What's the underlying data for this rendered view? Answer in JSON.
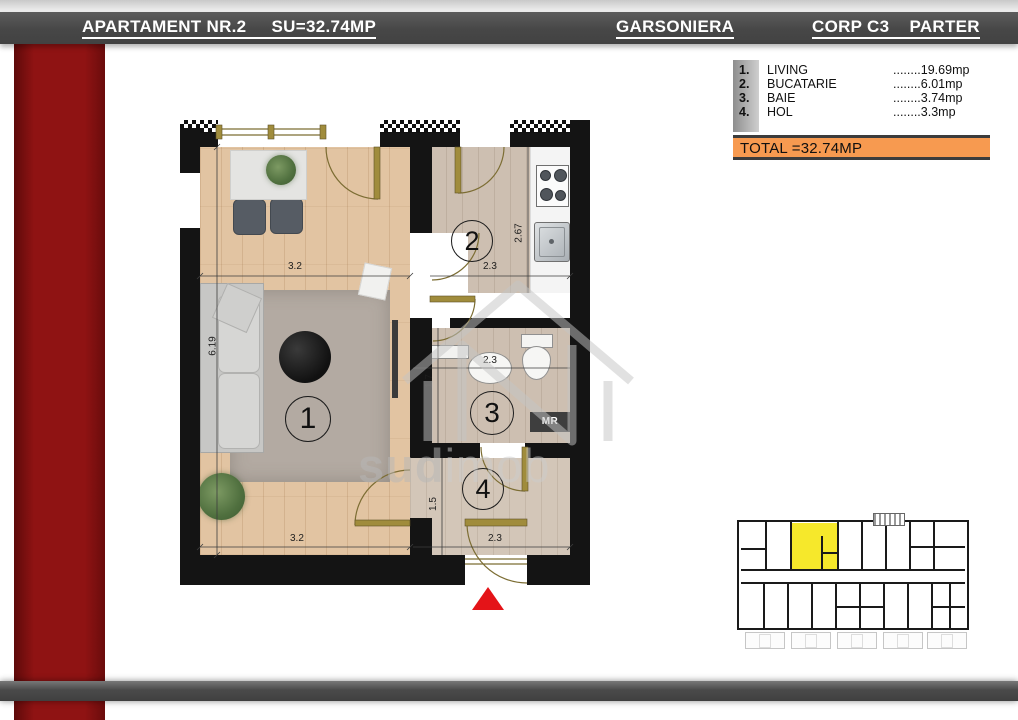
{
  "header": {
    "left": "APARTAMENT NR.2     SU=32.74MP",
    "center": "GARSONIERA",
    "right": "CORP C3    PARTER"
  },
  "legend": {
    "items": [
      {
        "num": "1.",
        "name": "LIVING",
        "value": "........19.69mp"
      },
      {
        "num": "2.",
        "name": "BUCATARIE",
        "value": "........6.01mp"
      },
      {
        "num": "3.",
        "name": "BAIE",
        "value": "........3.74mp"
      },
      {
        "num": "4.",
        "name": "HOL",
        "value": "........3.3mp"
      }
    ],
    "total": "TOTAL =32.74MP"
  },
  "plan": {
    "rooms": {
      "living": "1",
      "kitchen": "2",
      "bath": "3",
      "hall": "4"
    },
    "dims": {
      "living_top": "3.2",
      "living_left": "6.19",
      "kitchen_w": "2.3",
      "kitchen_h": "2.67",
      "bath_w": "2.3",
      "bath_h": "1.7",
      "hall_h": "1.5",
      "hall_w": "2.3",
      "living_bottom": "3.2"
    },
    "labels": {
      "mr": "MR"
    }
  },
  "watermark": {
    "part1": "sud",
    "part2": "imob"
  },
  "colors": {
    "accent_red": "#8f1313",
    "header_gray": "#474747",
    "total_orange": "#f79a50",
    "highlight_yellow": "#f6e82b",
    "triangle_red": "#e41418"
  }
}
